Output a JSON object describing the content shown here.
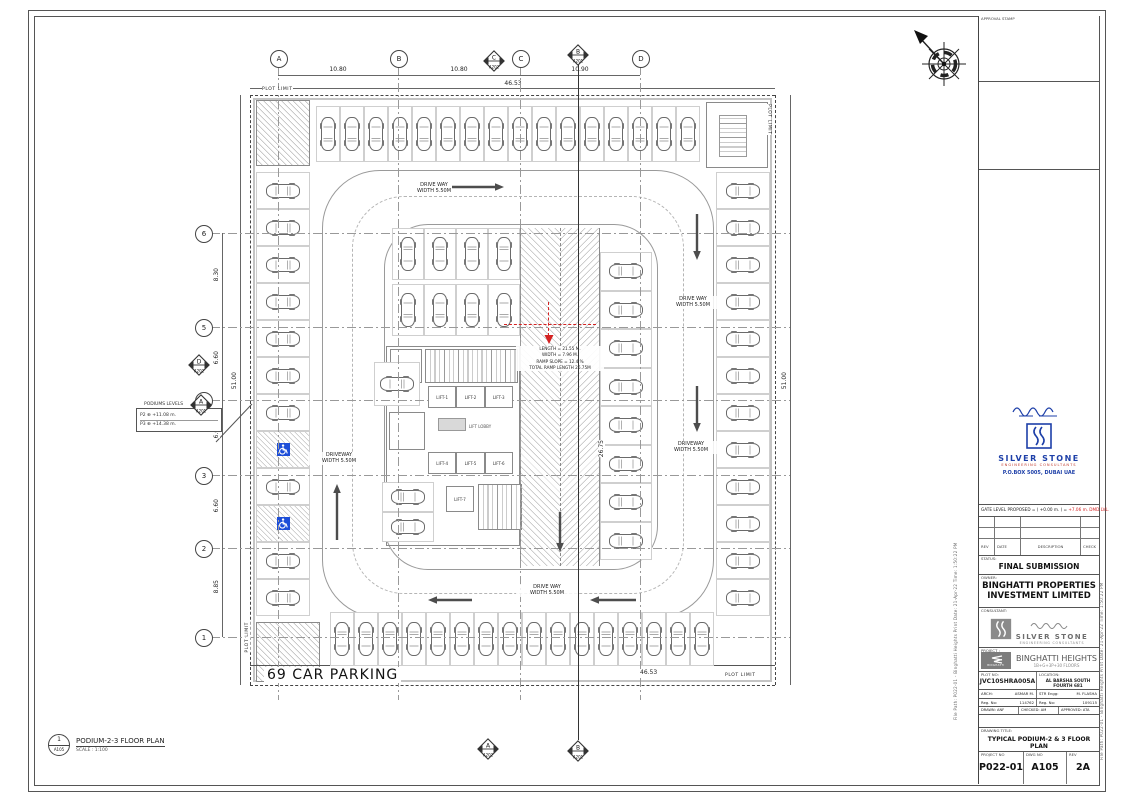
{
  "sheet": {
    "approval_stamp": "APPROVAL STAMP"
  },
  "edge_notes": {
    "left": "File Path: P022-01 - Binghatti Heights   Print Date: 21-Apr-22  Time: 1:50:22 PM",
    "right": "File Path: P022-01 - Binghatti Heights   Print Date: 21-Apr-22  Time: 1:50:22 PM"
  },
  "colors": {
    "brand_blue": "#1d3fa8",
    "accent_red": "#d42222",
    "logo_gray": "#8a8a8a"
  },
  "titleblock": {
    "gate_level_black": "GATE LEVEL PROPOSED = ( +0.00 m. ) = ",
    "gate_level_red": "+7.06 m. DMD LVL.",
    "rev_table": {
      "headers": [
        "REV",
        "DATE",
        "DESCRIPTION",
        "CHECK"
      ]
    },
    "status_label": "STATUS:",
    "status_value": "FINAL SUBMISSION",
    "owner_label": "OWNER:",
    "owner_value": "BINGHATTI PROPERTIES INVESTMENT LIMITED",
    "stamp": {
      "name": "SILVER STONE",
      "sub": "ENGINEERING CONSULTANTS",
      "pobox": "P.O.BOX 5005, DUBAI UAE"
    },
    "consultant_label": "CONSULTANT:",
    "consultant_name": "SILVER STONE",
    "consultant_sub": "ENGINEERING CONSULTANTS",
    "project_label": "PROJECT :",
    "project_logo": "BINGHATTI",
    "project_name": "BINGHATTI HEIGHTS",
    "project_sub": "1B+G+3P+30 FLOORS",
    "plot_label": "PLOT NO:",
    "plot_value": "JVC10SHRA005A",
    "location_label": "LOCATION:",
    "location_value": "AL BARSHA SOUTH FOURTH 681",
    "arch_label": "ARCH:",
    "arch_value": "ASMAR M.",
    "str_label": "STR Engg:",
    "str_value": "M. FLASHA",
    "reg1_label": "Reg. No:",
    "reg1_value": "114762",
    "reg2_label": "Reg. No:",
    "reg2_value": "109115",
    "drawn_label": "DRAWN:",
    "drawn_value": "ANF",
    "checked_label": "CHECKED:",
    "checked_value": "AM",
    "approved_label": "APPROVED:",
    "approved_value": "ATA",
    "title_label": "DRAWING TITLE:",
    "title_value": "TYPICAL PODIUM-2 & 3 FLOOR PLAN",
    "projno_label": "PROJECT NO",
    "projno_value": "P022-01",
    "dwg_label": "DWG NO",
    "dwg_value": "A105",
    "rev_label": "REV",
    "rev_value": "2A"
  },
  "plan": {
    "caption": "69 CAR PARKING",
    "plot_limit": "PLOT LIMIT",
    "view_num": "1",
    "view_sheet": "A105",
    "view_title": "PODIUM-2-3 FLOOR PLAN",
    "view_scale": "SCALE : 1:100",
    "grid": {
      "cols": [
        "A",
        "B",
        "C",
        "D"
      ],
      "rows_top_to_bottom": [
        "6",
        "5",
        "4",
        "3",
        "2",
        "1"
      ],
      "col_dims": [
        "10.80",
        "10.80",
        "10.90"
      ],
      "row_dims_top_to_bottom": [
        "8.30",
        "6.60",
        "6.60",
        "6.60",
        "8.85"
      ],
      "overall_w": "46.53",
      "overall_h": "51.00"
    },
    "driveway_labels": [
      {
        "line1": "DRIVE WAY",
        "line2": "WIDTH 5.50M"
      },
      {
        "line1": "DRIVEWAY",
        "line2": "WIDTH 5.50M"
      },
      {
        "line1": "DRIVE WAY",
        "line2": "WIDTH 5.50M"
      },
      {
        "line1": "DRIVEWAY",
        "line2": "WIDTH 5.50M"
      },
      {
        "line1": "DRIVE WAY",
        "line2": "WIDTH 5.50M"
      }
    ],
    "ramp": {
      "lines": [
        "LENGTH = 21.55 M.",
        "WIDTH = 7.96 M.",
        "RAMP SLOPE = 12.4 %",
        "TOTAL RAMP LENGTH 26.75M"
      ],
      "dim": "26.75"
    },
    "lifts": [
      "LIFT-1",
      "LIFT-2",
      "LIFT-3",
      "LIFT-4",
      "LIFT-5",
      "LIFT-6",
      "LIFT-7"
    ],
    "lift_lobby": "LIFT LOBBY",
    "podium_levels": {
      "title": "PODIUMS LEVELS",
      "lines": [
        "P2 ⊕ +11.08 m.",
        "P3 ⊕ +14.38 m."
      ]
    },
    "markers": {
      "top": [
        {
          "letter": "C",
          "sheet": "A202"
        },
        {
          "letter": "B",
          "sheet": "A201"
        }
      ],
      "bottom": [
        {
          "letter": "A",
          "sheet": "A202"
        },
        {
          "letter": "B",
          "sheet": "A201"
        }
      ],
      "left": [
        {
          "letter": "D",
          "sheet": "A202"
        },
        {
          "letter": "A",
          "sheet": "A201"
        }
      ]
    }
  }
}
